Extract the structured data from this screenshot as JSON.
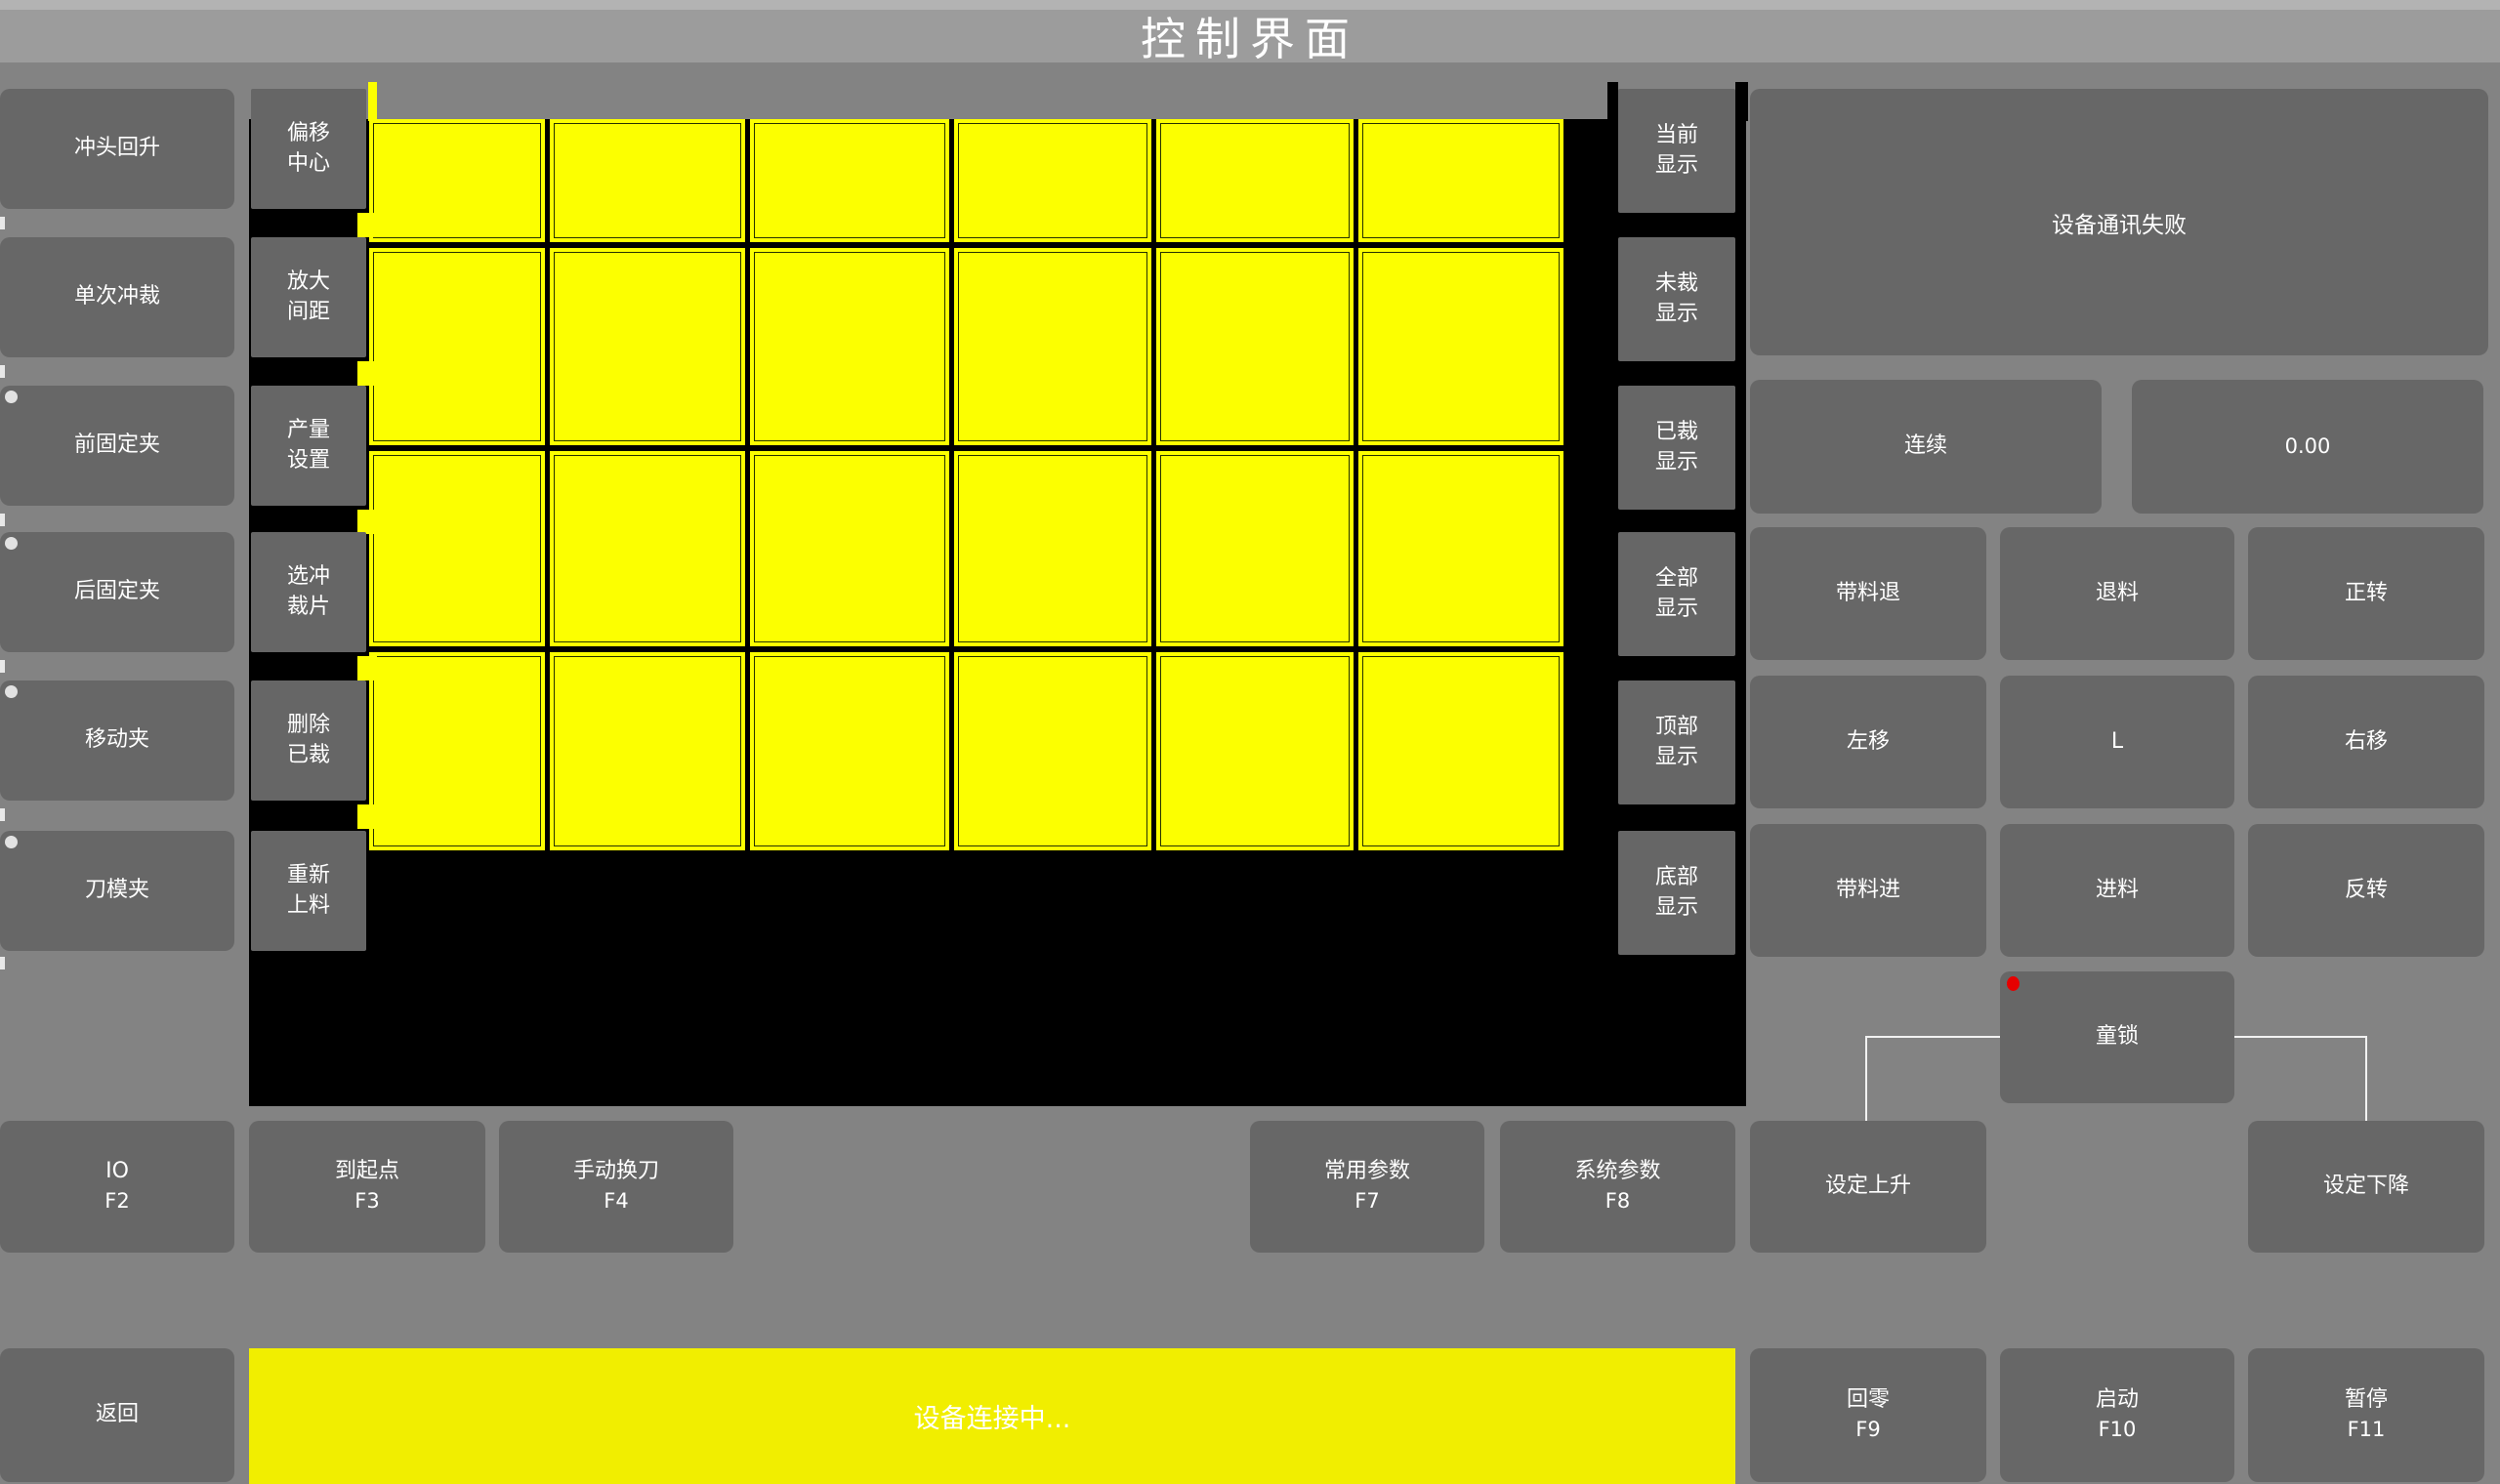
{
  "title_bar": {
    "title": "控制界面"
  },
  "left_panel": {
    "buttons": [
      {
        "label": "冲头回升",
        "indicator": false
      },
      {
        "label": "单次冲裁",
        "indicator": false
      },
      {
        "label": "前固定夹",
        "indicator": true
      },
      {
        "label": "后固定夹",
        "indicator": true
      },
      {
        "label": "移动夹",
        "indicator": true
      },
      {
        "label": "刀模夹",
        "indicator": true
      }
    ]
  },
  "tool_panel": {
    "buttons": [
      {
        "line1": "偏移",
        "line2": "中心"
      },
      {
        "line1": "放大",
        "line2": "间距"
      },
      {
        "line1": "产量",
        "line2": "设置"
      },
      {
        "line1": "选冲",
        "line2": "裁片"
      },
      {
        "line1": "删除",
        "line2": "已裁"
      },
      {
        "line1": "重新",
        "line2": "上料"
      }
    ]
  },
  "display_panel": {
    "buttons": [
      {
        "line1": "当前",
        "line2": "显示"
      },
      {
        "line1": "未裁",
        "line2": "显示"
      },
      {
        "line1": "已裁",
        "line2": "显示"
      },
      {
        "line1": "全部",
        "line2": "显示"
      },
      {
        "line1": "顶部",
        "line2": "显示"
      },
      {
        "line1": "底部",
        "line2": "显示"
      }
    ]
  },
  "canvas": {
    "grid_rows": 4,
    "grid_cols": 6,
    "cell_color": "#fcff00",
    "cell_outline": "#263300",
    "background": "#000000"
  },
  "right_panel": {
    "status_message": "设备通讯失败",
    "mode_button": "连续",
    "value_display": "0.00",
    "jog_buttons": [
      "带料退",
      "退料",
      "正转",
      "左移",
      "L",
      "右移",
      "带料进",
      "进料",
      "反转"
    ],
    "child_lock": {
      "label": "童锁",
      "indicator_color": "#e60000"
    }
  },
  "function_row": {
    "buttons": [
      {
        "label": "IO",
        "key": "F2"
      },
      {
        "label": "到起点",
        "key": "F3"
      },
      {
        "label": "手动换刀",
        "key": "F4"
      },
      {
        "label": "常用参数",
        "key": "F7"
      },
      {
        "label": "系统参数",
        "key": "F8"
      },
      {
        "label": "设定上升",
        "key": ""
      },
      {
        "label": "设定下降",
        "key": ""
      }
    ]
  },
  "bottom_bar": {
    "back_button": "返回",
    "status_message": "设备连接中...",
    "buttons": [
      {
        "label": "回零",
        "key": "F9"
      },
      {
        "label": "启动",
        "key": "F10"
      },
      {
        "label": "暂停",
        "key": "F11"
      }
    ]
  },
  "colors": {
    "status_bar_yellow": "#f1ee00",
    "grid_yellow": "#fcff00",
    "button_gray": "#676767",
    "indicator_red": "#e60000"
  }
}
